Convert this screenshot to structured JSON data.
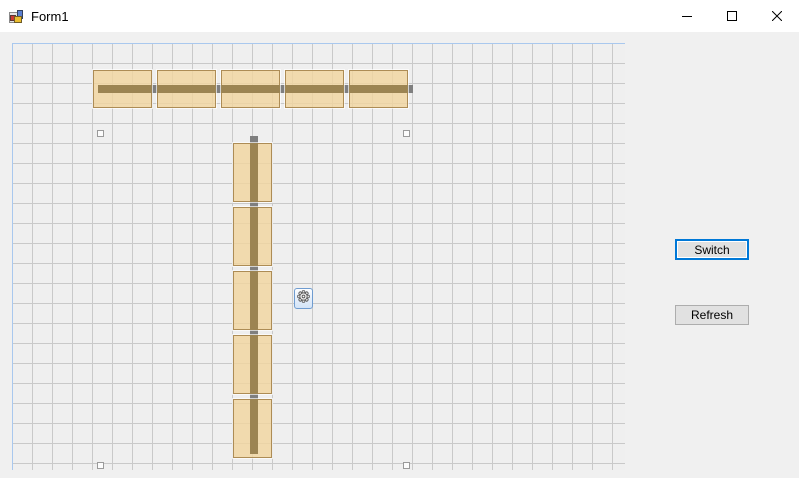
{
  "window": {
    "title": "Form1",
    "controls": [
      {
        "name": "minimize"
      },
      {
        "name": "maximize"
      },
      {
        "name": "close"
      }
    ]
  },
  "panel": {
    "buttons": [
      {
        "id": "switch",
        "label": "Switch",
        "focused": true
      },
      {
        "id": "refresh",
        "label": "Refresh",
        "focused": false
      }
    ]
  },
  "canvas": {
    "grid_size": 20,
    "colors": {
      "canvas_bg": "#efefef",
      "canvas_border": "#a9c8ee",
      "grid": "#c9c9c9",
      "module_fill": "rgba(241,214,160,0.82)",
      "module_border": "#ad8c55",
      "beam": "#7f7f7f",
      "beam_overlap": "#9c8452",
      "anchor_fill": "#fcfcfc",
      "anchor_border": "#9a9a9a",
      "gear_border": "#6f9cd0",
      "focus_accent": "#0078d7"
    },
    "conveyors": [
      {
        "id": "conveyor-horizontal",
        "orientation": "horizontal",
        "beam": {
          "x": 85,
          "y": 41,
          "w": 315,
          "h": 8
        },
        "modules": [
          {
            "x": 80,
            "y": 26,
            "w": 59,
            "h": 38
          },
          {
            "x": 144,
            "y": 26,
            "w": 59,
            "h": 38
          },
          {
            "x": 208,
            "y": 26,
            "w": 59,
            "h": 38
          },
          {
            "x": 272,
            "y": 26,
            "w": 59,
            "h": 38
          },
          {
            "x": 336,
            "y": 26,
            "w": 59,
            "h": 38
          }
        ]
      },
      {
        "id": "conveyor-vertical",
        "orientation": "vertical",
        "beam": {
          "x": 237,
          "y": 92,
          "w": 8,
          "h": 318
        },
        "modules": [
          {
            "x": 220,
            "y": 99,
            "w": 39,
            "h": 59
          },
          {
            "x": 220,
            "y": 163,
            "w": 39,
            "h": 59
          },
          {
            "x": 220,
            "y": 227,
            "w": 39,
            "h": 59
          },
          {
            "x": 220,
            "y": 291,
            "w": 39,
            "h": 59
          },
          {
            "x": 220,
            "y": 355,
            "w": 39,
            "h": 59
          }
        ]
      }
    ],
    "anchors": [
      {
        "x": 84,
        "y": 86
      },
      {
        "x": 390,
        "y": 86
      },
      {
        "x": 84,
        "y": 418
      },
      {
        "x": 390,
        "y": 418
      }
    ],
    "gear": {
      "x": 281,
      "y": 244,
      "w": 19,
      "h": 21
    }
  }
}
